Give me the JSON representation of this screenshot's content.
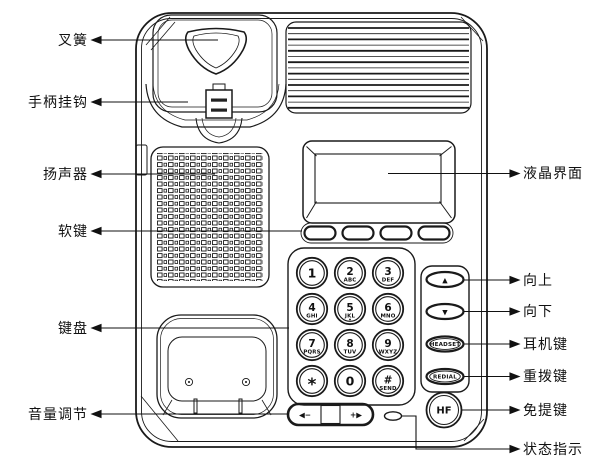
{
  "figure": {
    "type": "telephone-parts-diagram",
    "background": "#ffffff",
    "line_color": "#1a1a1a"
  },
  "callouts": {
    "left": [
      "叉簧",
      "手柄挂钩",
      "扬声器",
      "软键",
      "键盘",
      "音量调节"
    ],
    "right": [
      "液晶界面",
      "向上",
      "向下",
      "耳机键",
      "重拨键",
      "免提键",
      "状态指示"
    ]
  },
  "phone": {
    "keypad_keys": [
      {
        "digit": "1",
        "letters": ""
      },
      {
        "digit": "2",
        "letters": "ABC"
      },
      {
        "digit": "3",
        "letters": "DEF"
      },
      {
        "digit": "4",
        "letters": "GHI"
      },
      {
        "digit": "5",
        "letters": "JKL"
      },
      {
        "digit": "6",
        "letters": "MNO"
      },
      {
        "digit": "7",
        "letters": "PQRS"
      },
      {
        "digit": "8",
        "letters": "TUV"
      },
      {
        "digit": "9",
        "letters": "WXYZ"
      },
      {
        "digit": "*",
        "letters": ""
      },
      {
        "digit": "0",
        "letters": ""
      },
      {
        "digit": "#",
        "letters": "SEND"
      }
    ],
    "nav_buttons": {
      "up": "▲",
      "down": "▼",
      "headset": "HEADSET",
      "redial": "REDIAL"
    },
    "handsfree_label": "HF",
    "volume": {
      "down": "◀−",
      "up": "+▶"
    }
  }
}
